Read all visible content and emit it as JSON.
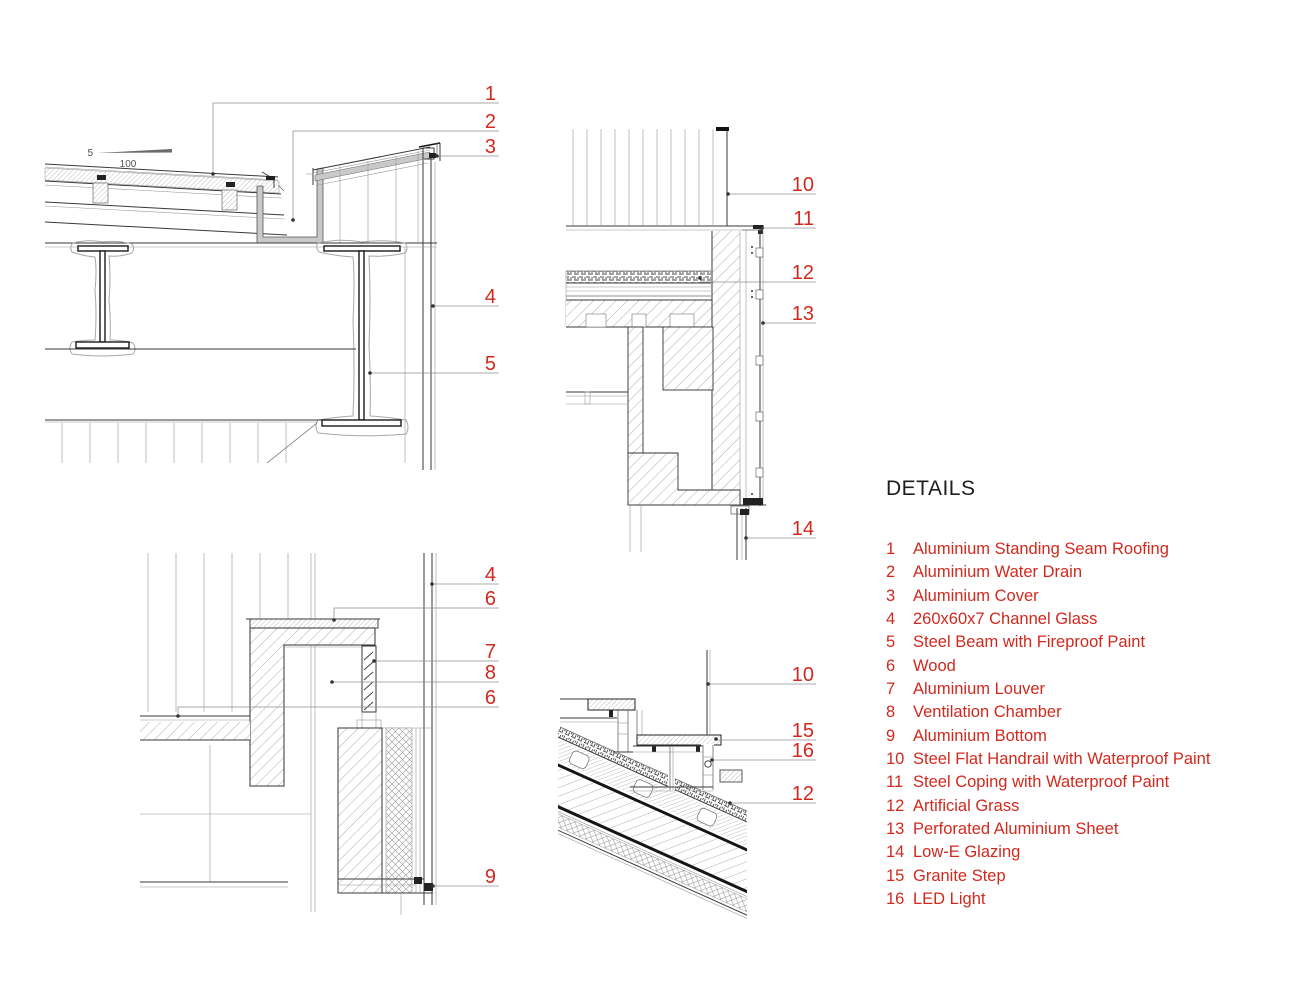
{
  "sheet": {
    "background": "#ffffff"
  },
  "colors": {
    "callout_red": "#d2291e",
    "line_dark": "#3a3a3a",
    "hatch_gray": "#9a9a9a",
    "gutter_gray": "#c9c9c9"
  },
  "legend": {
    "title": "DETAILS",
    "items": [
      {
        "num": "1",
        "label": "Aluminium Standing Seam Roofing"
      },
      {
        "num": "2",
        "label": "Aluminium Water Drain"
      },
      {
        "num": "3",
        "label": "Aluminium Cover"
      },
      {
        "num": "4",
        "label": "260x60x7 Channel Glass"
      },
      {
        "num": "5",
        "label": "Steel Beam with Fireproof Paint"
      },
      {
        "num": "6",
        "label": "Wood"
      },
      {
        "num": "7",
        "label": "Aluminium Louver"
      },
      {
        "num": "8",
        "label": "Ventilation Chamber"
      },
      {
        "num": "9",
        "label": "Aluminium Bottom"
      },
      {
        "num": "10",
        "label": "Steel Flat Handrail with Waterproof Paint"
      },
      {
        "num": "11",
        "label": "Steel Coping with Waterproof Paint"
      },
      {
        "num": "12",
        "label": "Artificial Grass"
      },
      {
        "num": "13",
        "label": "Perforated Aluminium Sheet"
      },
      {
        "num": "14",
        "label": "Low-E Glazing"
      },
      {
        "num": "15",
        "label": "Granite Step"
      },
      {
        "num": "16",
        "label": "LED Light"
      }
    ]
  },
  "drawings": {
    "roof_eave": {
      "slope_rise": "5",
      "slope_run": "100",
      "callouts": [
        "1",
        "2",
        "3",
        "4",
        "5"
      ]
    },
    "parapet": {
      "callouts": [
        "10",
        "11",
        "12",
        "13",
        "14"
      ]
    },
    "wall_louver": {
      "callouts": [
        "4",
        "6",
        "7",
        "8",
        "6",
        "9"
      ]
    },
    "roof_step": {
      "callouts": [
        "10",
        "15",
        "16",
        "12"
      ]
    }
  }
}
